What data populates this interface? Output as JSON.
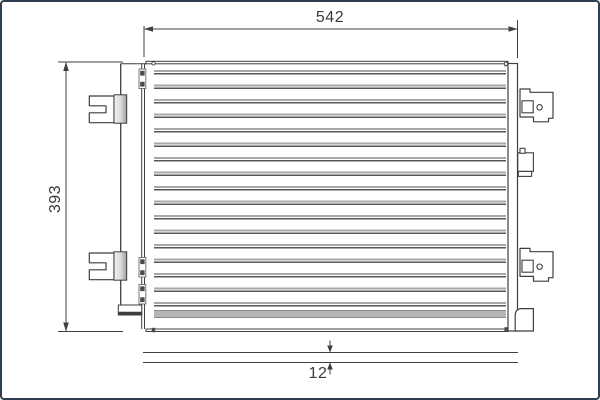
{
  "drawing": {
    "type": "technical-drawing",
    "subject": "condenser-front-view-with-depth-detail",
    "dimensions": {
      "width": "542",
      "height": "393",
      "depth": "12"
    }
  },
  "colors": {
    "frame_border": "#2d3f50",
    "line_dark": "#3f3f3f",
    "line_gray": "#a8a8a8",
    "background": "#ffffff",
    "text": "#3a3a3a"
  }
}
